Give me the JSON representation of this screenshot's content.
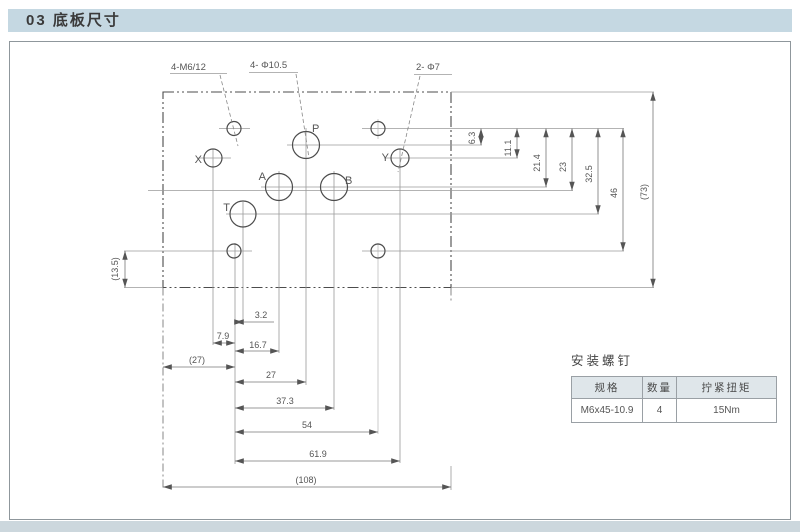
{
  "page": {
    "header_title": "03 底板尺寸"
  },
  "drawing": {
    "callouts": {
      "mounting_holes": "4-M6/12",
      "main_ports": "4- Φ10.5",
      "pilot_ports": "2- Φ7"
    },
    "ports": {
      "p": "P",
      "a": "A",
      "b": "B",
      "t": "T",
      "x": "X",
      "y": "Y"
    },
    "dims_right": [
      "6.3",
      "11.1",
      "21.4",
      "23",
      "32.5",
      "46",
      "(73)"
    ],
    "dims_bottom": [
      "3.2",
      "7.9",
      "16.7",
      "(27)",
      "27",
      "37.3",
      "54",
      "61.9",
      "(108)"
    ],
    "dims_left": [
      "(13.5)"
    ]
  },
  "table": {
    "title": "安装螺钉",
    "headers": [
      "规格",
      "数量",
      "拧紧扭矩"
    ],
    "rows": [
      [
        "M6x45-10.9",
        "4",
        "15Nm"
      ]
    ]
  },
  "colors": {
    "header_bg": "#c5d8e2",
    "bottom_strip_bg": "#ccd7dd",
    "table_header_bg": "#dfe6ea"
  }
}
